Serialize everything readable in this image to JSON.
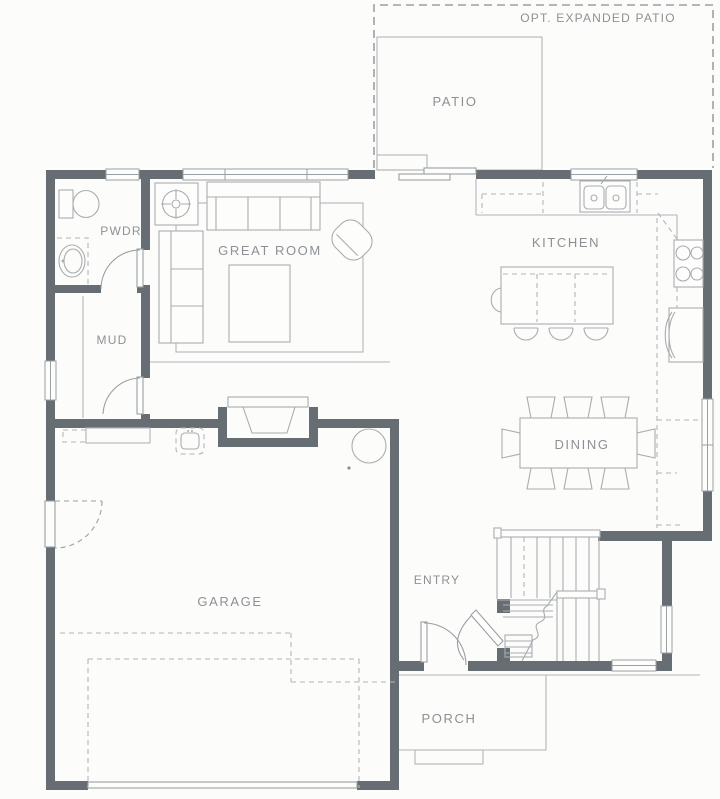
{
  "title": "Residential first-floor plan",
  "colors": {
    "background": "#fcfcfb",
    "wall": "#676e73",
    "furniture_line": "#b2b5b7",
    "fixture_line": "#a9adaf",
    "dashed_line": "#9aa0a3",
    "label_text": "#8d9194"
  },
  "labels": {
    "opt_expanded_patio": "OPT. EXPANDED PATIO",
    "patio": "PATIO",
    "pwdr": "PWDR",
    "great_room": "GREAT ROOM",
    "kitchen": "KITCHEN",
    "mud": "MUD",
    "dining": "DINING",
    "garage": "GARAGE",
    "entry": "ENTRY",
    "porch": "PORCH"
  },
  "icons": {
    "fireplace": "fireplace-icon",
    "ceiling_fixture": "ceiling-fixture-icon",
    "toilet": "toilet-icon",
    "vanity_sink": "sink-icon",
    "kitchen_sink": "double-sink-icon",
    "range": "range-icon",
    "refrigerator": "refrigerator-icon",
    "water_heater": "water-heater-icon",
    "utility_sink": "utility-sink-icon",
    "stairs": "stairs-icon"
  }
}
